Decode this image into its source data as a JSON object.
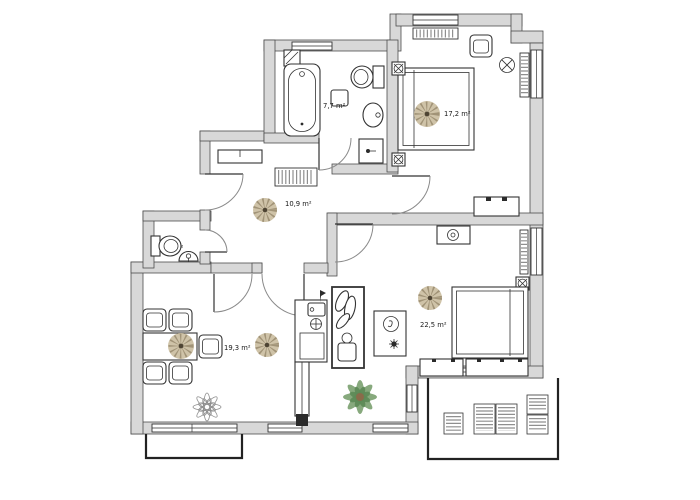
{
  "document": {
    "type": "apartment-floor-plan",
    "units": "m²"
  },
  "colors": {
    "wall_fill": "#d8d8d8",
    "wall_stroke": "#4d4d4d",
    "line": "#333333",
    "door_arc": "#8a8a8a",
    "radiator": "#8f8f8f",
    "terrace_stroke": "#222222",
    "fan_disc": "#cfc3a8",
    "fan_spokes": "#8d7f63",
    "fan_center": "#4e4433",
    "plant_light": "#7aa06f",
    "plant_dark": "#5d8a57"
  },
  "rooms": [
    {
      "id": "bathroom",
      "area_label": "7,7 m²"
    },
    {
      "id": "bedroom-top",
      "area_label": "17,2 m²"
    },
    {
      "id": "hallway",
      "area_label": "10,9 m²"
    },
    {
      "id": "wc",
      "area_label": "1,6 m²"
    },
    {
      "id": "living-room",
      "area_label": "19,3 m²"
    },
    {
      "id": "bedroom-bottom",
      "area_label": "22,5 m²"
    }
  ],
  "symbols": {
    "ceiling_fan": "beige sunburst circle",
    "ceiling_lamp": "circle with X",
    "electrical_marker": "square with circled X",
    "radiator": "hatched bar",
    "window": "double-line bar in wall"
  }
}
